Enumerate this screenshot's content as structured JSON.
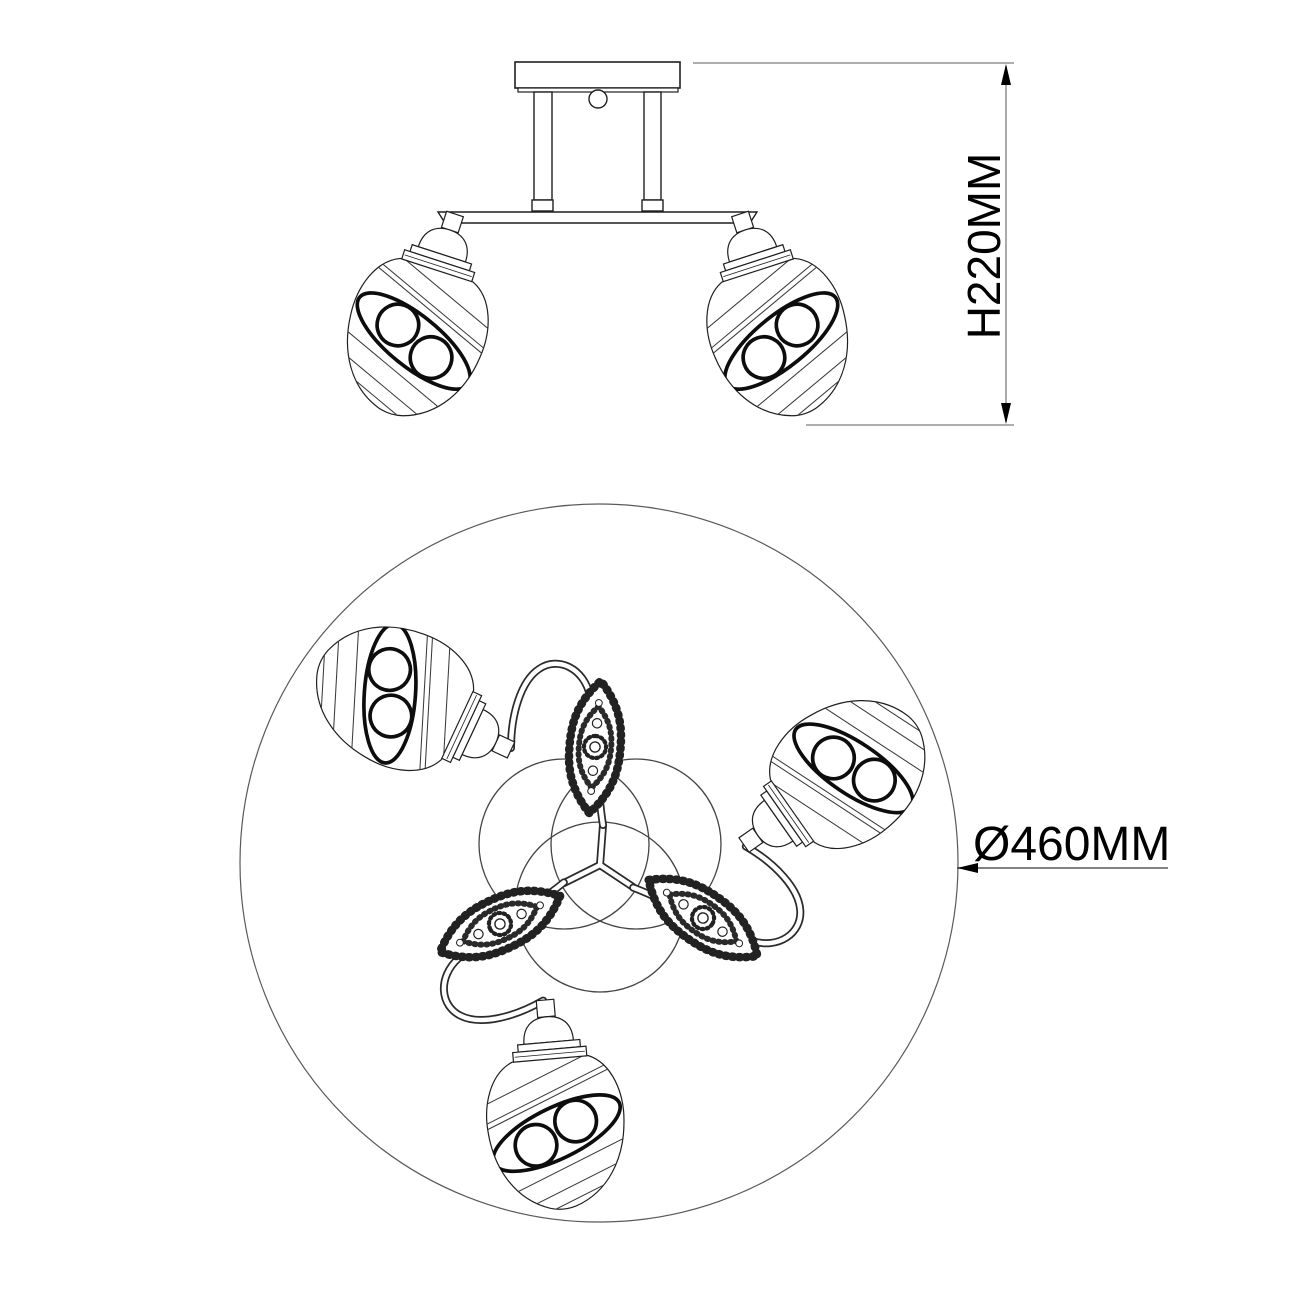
{
  "drawing": {
    "type": "technical-dimension-drawing",
    "subject": "3-light ceiling chandelier",
    "dimensions": {
      "height": {
        "label": "H220MM"
      },
      "diameter": {
        "label": "Ø460MM"
      }
    },
    "colors": {
      "line": "#1f1f1f",
      "thin_line": "#444444",
      "dimension_line": "#7d7d7d",
      "text": "#000000",
      "background": "#ffffff"
    }
  }
}
